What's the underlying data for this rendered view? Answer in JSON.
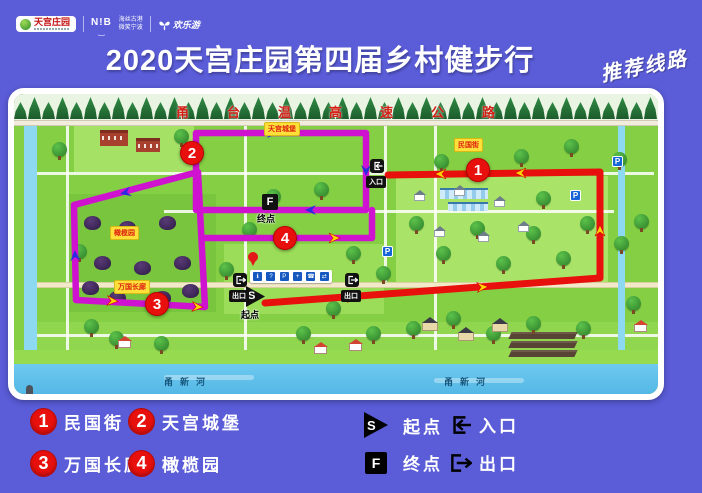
{
  "header": {
    "logo_tiangong": "天宫庄园",
    "logo_nib": "N!B",
    "logo_nib_smile": "‿",
    "slogan_line1": "海丝古港",
    "slogan_line2": "微笑宁波",
    "logo_fun": "欢乐游",
    "title": "2020天宫庄园第四届乡村健步行",
    "route_tag": "推荐线路"
  },
  "map": {
    "expressway": "甬台温高速公路",
    "river": "甬新河",
    "start_letter": "S",
    "finish_letter": "F",
    "start_label": "起点",
    "finish_label": "终点",
    "entrance_label": "入口",
    "exit_label": "出口",
    "parking_letter": "P",
    "markers": [
      {
        "num": "1",
        "name": "民国街"
      },
      {
        "num": "2",
        "name": "天宫城堡"
      },
      {
        "num": "3",
        "name": "万国长廊"
      },
      {
        "num": "4",
        "name": "橄榄园"
      }
    ],
    "services": [
      "ℹ",
      "?",
      "P",
      "+",
      "☎",
      "⇄"
    ]
  },
  "legend": {
    "items": [
      {
        "num": "1",
        "label": "民国街"
      },
      {
        "num": "2",
        "label": "天宫城堡"
      },
      {
        "num": "3",
        "label": "万国长廊"
      },
      {
        "num": "4",
        "label": "橄榄园"
      }
    ],
    "start": {
      "letter": "S",
      "label": "起点"
    },
    "finish": {
      "letter": "F",
      "label": "终点"
    },
    "entrance": "入口",
    "exit": "出口"
  },
  "colors": {
    "background_blue": "#5a5cd8",
    "route_red": "#e8100c",
    "route_purple": "#cf12cf",
    "marker_red": "#e8100c",
    "arrow_yellow": "#ffd400",
    "arrow_blue": "#2a2ae0"
  }
}
